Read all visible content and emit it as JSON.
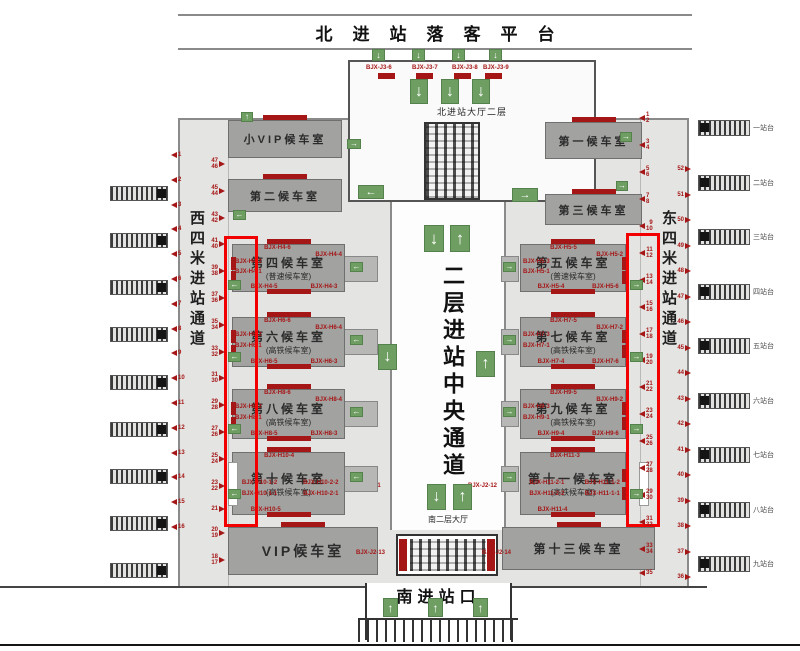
{
  "header": {
    "north_platform_title": "北进站落客平台"
  },
  "north_hall": {
    "name": "北进站大厅二层",
    "gate_labels": [
      "BJX-J3-6",
      "BJX-J3-7",
      "BJX-J3-8",
      "BJX-J3-9"
    ]
  },
  "central_corridor": {
    "name": "二层进站中央通道",
    "south_hall_label": "南二层大厅",
    "gate_left": "BJX-J2-11",
    "gate_right": "BJX-J2-12"
  },
  "south": {
    "entrance_title": "南进站口",
    "escalator_gate_left": "BJX-J2-13",
    "escalator_gate_right": "BJX-J2-14"
  },
  "passages": {
    "west": "西四米进站通道",
    "east": "东四米进站通道"
  },
  "rooms": [
    {
      "cls": "room--svip",
      "side": "L",
      "name": "小VIP候车室"
    },
    {
      "cls": "room--w2",
      "side": "L",
      "name": "第二候车室"
    },
    {
      "cls": "room--w1",
      "side": "R",
      "name": "第一候车室"
    },
    {
      "cls": "room--w3",
      "side": "R",
      "name": "第三候车室"
    },
    {
      "cls": "room--w4",
      "side": "L",
      "sb": true,
      "name": "第四候车室",
      "sub": "(普速候车室)",
      "t": "BJX-H4-6",
      "r": "BJX-H4-4",
      "l1": "BJX-H4-2",
      "l2": "BJX-H4-1",
      "b1": "BJX-H4-5",
      "b2": "BJX-H4-3"
    },
    {
      "cls": "room--w5",
      "side": "R",
      "sb": true,
      "name": "第五候车室",
      "sub": "(普速候车室)",
      "t": "BJX-H5-5",
      "r": "BJX-H5-2",
      "l1": "BJX-H5-3",
      "l2": "BJX-H5-1",
      "b1": "BJX-H5-4",
      "b2": "BJX-H5-6"
    },
    {
      "cls": "room--w6",
      "side": "L",
      "sb": true,
      "name": "第六候车室",
      "sub": "(高铁候车室)",
      "t": "BJX-H6-6",
      "r": "BJX-H6-4",
      "l1": "BJX-H6-2",
      "l2": "BJX-H6-1",
      "b1": "BJX-H6-5",
      "b2": "BJX-H6-3"
    },
    {
      "cls": "room--w7",
      "side": "R",
      "sb": true,
      "name": "第七候车室",
      "sub": "(高铁候车室)",
      "t": "BJX-H7-5",
      "r": "BJX-H7-2",
      "l1": "BJX-H7-3",
      "l2": "BJX-H7-1",
      "b1": "BJX-H7-4",
      "b2": "BJX-H7-6"
    },
    {
      "cls": "room--w8",
      "side": "L",
      "sb": true,
      "name": "第八候车室",
      "sub": "(高铁候车室)",
      "t": "BJX-H8-6",
      "r": "BJX-H8-4",
      "l1": "BJX-H8-2",
      "l2": "BJX-H8-1",
      "b1": "BJX-H8-5",
      "b2": "BJX-H8-3"
    },
    {
      "cls": "room--w9",
      "side": "R",
      "sb": true,
      "name": "第九候车室",
      "sub": "(高铁候车室)",
      "t": "BJX-H9-5",
      "r": "BJX-H9-2",
      "l1": "BJX-H9-3",
      "l2": "BJX-H9-1",
      "b1": "BJX-H9-4",
      "b2": "BJX-H9-6"
    },
    {
      "cls": "room--w10",
      "side": "L",
      "sb": true,
      "name": "第十候车室",
      "sub": "(高铁候车室)",
      "t": "BJX-H10-4",
      "m1": "BJX-H10-1-2",
      "m2": "BJX-H10-2-2",
      "m3": "BJX-H10-1-1",
      "m4": "BJX-H10-2-1",
      "b1": "BJX-H10-5"
    },
    {
      "cls": "room--w11",
      "side": "R",
      "sb": true,
      "name": "第十一候车室",
      "sub": "(高铁候车室)",
      "t": "BJX-H11-3",
      "m1": "BJX-H11-2-1",
      "m2": "BJX-H11-1-2",
      "m3": "BJX-H11-2-2",
      "m4": "BJX-H11-1-1",
      "b1": "BJX-H11-4"
    },
    {
      "cls": "room--vip",
      "side": "L",
      "name": "VIP候车室"
    },
    {
      "cls": "room--w13",
      "side": "R",
      "name": "第十三候车室"
    }
  ],
  "platforms": {
    "right_labels": [
      "一站台",
      "二站台",
      "三站台",
      "四站台",
      "五站台",
      "六站台",
      "七站台",
      "八站台",
      "九站台"
    ]
  },
  "gate_numbers": {
    "left_outer": [
      "1",
      "2",
      "3",
      "4",
      "5",
      "6",
      "7",
      "8",
      "9",
      "10",
      "11",
      "12",
      "13",
      "14",
      "15",
      "16"
    ],
    "left_inner": [
      "47\n46",
      "45\n44",
      "43\n42",
      "41\n40",
      "39\n38",
      "37\n36",
      "35\n34",
      "33\n32",
      "31\n30",
      "29\n28",
      "27\n26",
      "25\n24",
      "23\n22",
      "21",
      "20\n19",
      "18\n17"
    ],
    "right_inner": [
      "1\n2",
      "3\n4",
      "5\n6",
      "7\n8",
      "9\n10",
      "11\n12",
      "13\n14",
      "15\n16",
      "17\n18",
      "19\n20",
      "21\n22",
      "23\n24",
      "25\n26",
      "27\n28",
      "29\n30",
      "31\n32",
      "33\n34",
      "35"
    ],
    "right_mid": [
      "52",
      "51",
      "50",
      "49",
      "48",
      "47",
      "46",
      "45",
      "44",
      "43",
      "42",
      "41",
      "40",
      "39",
      "38",
      "37",
      "36"
    ]
  },
  "signs": [
    {
      "cls": "s-top1",
      "name": "down-arrow-sign",
      "g": "↓"
    },
    {
      "cls": "s-top2",
      "name": "down-arrow-sign",
      "g": "↓"
    },
    {
      "cls": "s-top3",
      "name": "down-arrow-sign",
      "g": "↓"
    },
    {
      "cls": "s-top4",
      "name": "down-arrow-sign",
      "g": "↓"
    },
    {
      "cls": "s-hall1",
      "name": "down-arrow-sign",
      "g": "↓"
    },
    {
      "cls": "s-hall2",
      "name": "down-arrow-sign",
      "g": "↓"
    },
    {
      "cls": "s-hall3",
      "name": "down-arrow-sign",
      "g": "↓"
    },
    {
      "cls": "s-ctd",
      "name": "down-arrow-sign",
      "g": "↓"
    },
    {
      "cls": "s-ctu",
      "name": "up-arrow-sign",
      "g": "↑"
    },
    {
      "cls": "s-cmd",
      "name": "down-arrow-sign",
      "g": "↓"
    },
    {
      "cls": "s-cmu",
      "name": "up-arrow-sign",
      "g": "↑"
    },
    {
      "cls": "s-cbd",
      "name": "down-arrow-sign",
      "g": "↓"
    },
    {
      "cls": "s-cbu",
      "name": "up-arrow-sign",
      "g": "↑"
    },
    {
      "cls": "s-south1",
      "name": "up-arrow-sign",
      "g": "↑"
    },
    {
      "cls": "s-south2",
      "name": "up-arrow-sign",
      "g": "↑"
    },
    {
      "cls": "s-south3",
      "name": "up-arrow-sign",
      "g": "↑"
    },
    {
      "cls": "s-halll",
      "name": "right-arrow-sign",
      "g": "→"
    },
    {
      "cls": "s-svip",
      "name": "up-arrow-sign",
      "g": "↑"
    },
    {
      "cls": "s-w2b",
      "name": "left-arrow-sign",
      "g": "←"
    },
    {
      "cls": "s-bigl",
      "name": "left-arrow-sign",
      "g": "←"
    },
    {
      "cls": "s-bigr",
      "name": "right-arrow-sign",
      "g": "→"
    },
    {
      "cls": "s-r1",
      "name": "right-arrow-sign",
      "g": "→"
    },
    {
      "cls": "s-w3",
      "name": "right-arrow-sign",
      "g": "→"
    },
    {
      "cls": "s-rb1",
      "name": "left-arrow-sign",
      "g": "←"
    },
    {
      "cls": "s-rb2",
      "name": "left-arrow-sign",
      "g": "←"
    },
    {
      "cls": "s-rb3",
      "name": "left-arrow-sign",
      "g": "←"
    },
    {
      "cls": "s-rb4",
      "name": "left-arrow-sign",
      "g": "←"
    },
    {
      "cls": "s-re1",
      "name": "right-arrow-sign",
      "g": "→"
    },
    {
      "cls": "s-re2",
      "name": "right-arrow-sign",
      "g": "→"
    },
    {
      "cls": "s-re3",
      "name": "right-arrow-sign",
      "g": "→"
    },
    {
      "cls": "s-re4",
      "name": "right-arrow-sign",
      "g": "→"
    },
    {
      "cls": "s-eb1",
      "name": "left-arrow-sign",
      "g": "←"
    },
    {
      "cls": "s-eb2",
      "name": "left-arrow-sign",
      "g": "←"
    },
    {
      "cls": "s-eb3",
      "name": "left-arrow-sign",
      "g": "←"
    },
    {
      "cls": "s-eb4",
      "name": "left-arrow-sign",
      "g": "←"
    },
    {
      "cls": "s-fb1",
      "name": "right-arrow-sign",
      "g": "→"
    },
    {
      "cls": "s-fb2",
      "name": "right-arrow-sign",
      "g": "→"
    },
    {
      "cls": "s-fb3",
      "name": "right-arrow-sign",
      "g": "→"
    },
    {
      "cls": "s-fb4",
      "name": "right-arrow-sign",
      "g": "→"
    }
  ]
}
